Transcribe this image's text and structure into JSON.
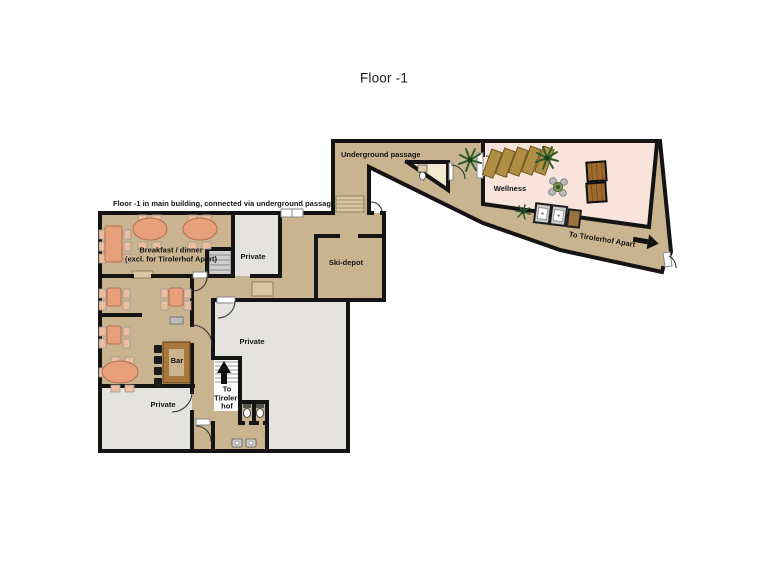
{
  "title": "Floor -1",
  "annotations": {
    "main_note": "Floor -1 in main building, connected via underground passage",
    "underground_passage": "Underground passage",
    "to_apart": "To Tirolerhof Apart"
  },
  "rooms": {
    "wellness": "Wellness",
    "breakfast_line1": "Breakfast / dinner",
    "breakfast_line2": "(excl. for Tirolerhof Apart)",
    "private_upper": "Private",
    "ski_depot": "Ski-depot",
    "private_main": "Private",
    "bar": "Bar",
    "private_lower": "Private",
    "stairs_label": [
      "To",
      "Tiroler-",
      "hof"
    ]
  },
  "arrows": {
    "to_tirolerhof_apart_direction": "right",
    "to_tirolerhof_direction": "up"
  },
  "colors": {
    "floor_tan": "#c9b48f",
    "floor_gray": "#e4e3e0",
    "wellness_pink": "#f8e4da",
    "wc_cream": "#f3ead0",
    "wall_black": "#141414",
    "wood_brown": "#a9763b",
    "table_salmon": "#e7a07a",
    "chair_salmon": "#edbd9e",
    "lounger_gold": "#b08e44",
    "plant_green": "#2e5d2e",
    "light_tan": "#d8c7a0"
  }
}
